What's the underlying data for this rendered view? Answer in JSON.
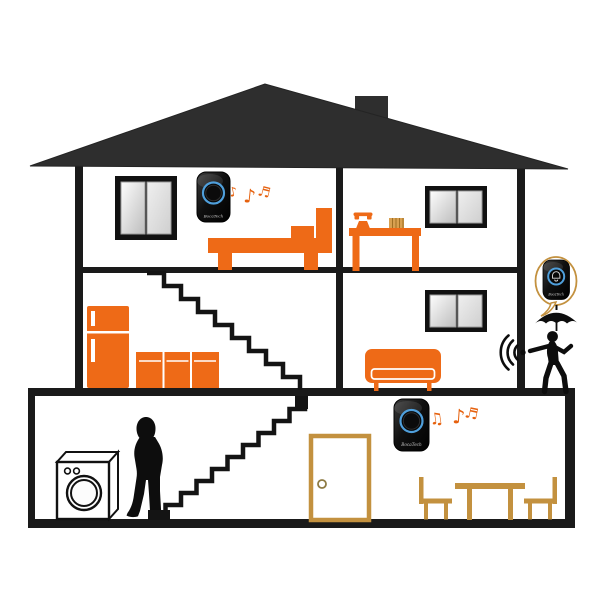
{
  "image": {
    "description": "Cutaway illustration of a three-level house showing a wireless doorbell kit: plug-in chime receivers playing music indoors and a remote doorbell push button shown in a speech bubble beside a man running with an umbrella outside.",
    "background_color": "#ffffff"
  },
  "devices": {
    "brand_label": "BocaTech",
    "ring_color": "#4f9fdb",
    "body_color": "#0c0c0c",
    "receiver_count": 2,
    "button_count": 1
  },
  "icons": {
    "music_notes_upstairs": [
      "♪",
      "♪",
      "♬"
    ],
    "music_notes_downstairs": [
      "♫",
      "♪",
      "♬"
    ],
    "wireless_signal": "signal-arcs",
    "bell_button": "bell-outline",
    "umbrella": "umbrella-silhouette",
    "telephone": "telephone-silhouette"
  },
  "palette": {
    "roof": "#2e2e2e",
    "structure": "#1a1a1a",
    "furniture_orange": "#ee6a17",
    "wood_tan": "#c3913f",
    "silhouette": "#0d0d0d",
    "window_frame": "#111111"
  },
  "rooms": {
    "bedroom": [
      "window",
      "doorbell-receiver",
      "music-notes",
      "bed"
    ],
    "office": [
      "telephone",
      "desk",
      "books",
      "window"
    ],
    "kitchen": [
      "fridge",
      "cabinets",
      "upper-staircase"
    ],
    "living_room": [
      "window",
      "couch",
      "wireless-signal"
    ],
    "ground_floor": [
      "washing-machine",
      "woman",
      "lower-staircase",
      "front-door",
      "doorbell-receiver",
      "music-notes",
      "dining-table",
      "dining-chairs"
    ],
    "outside": [
      "speech-bubble",
      "doorbell-button",
      "umbrella",
      "running-man"
    ]
  }
}
